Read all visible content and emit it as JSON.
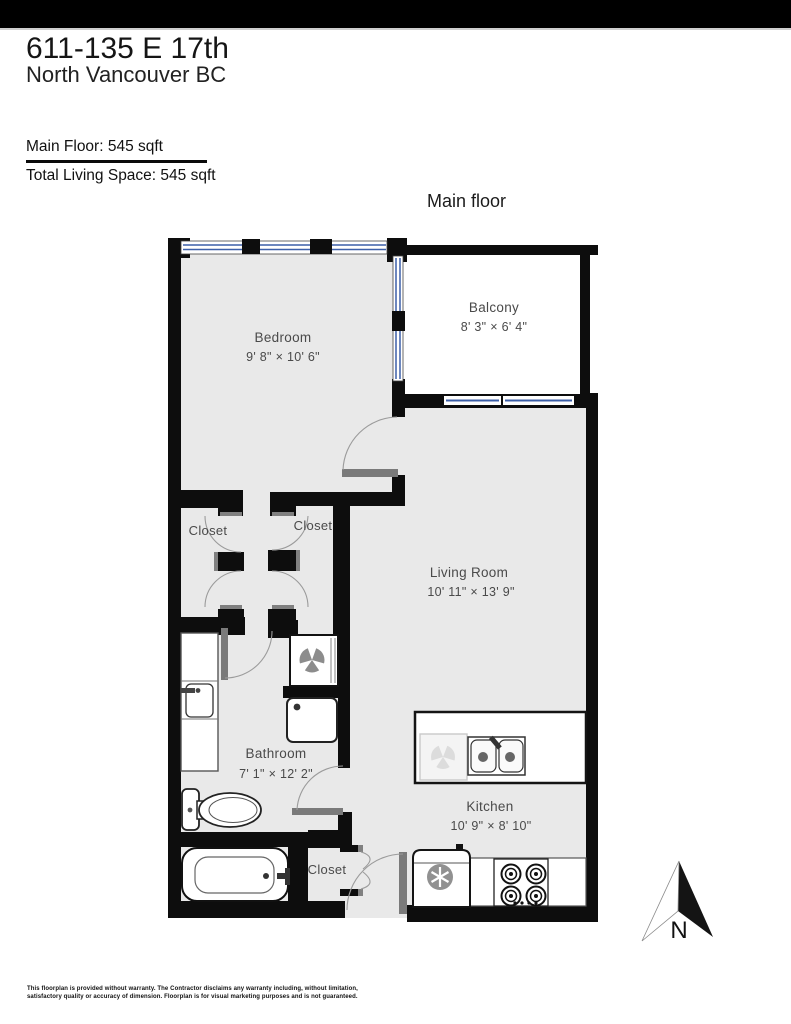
{
  "header": {
    "address_line1": "611-135 E 17th",
    "address_line2": "North Vancouver BC",
    "main_floor_label": "Main Floor: 545 sqft",
    "total_label": "Total Living Space: 545 sqft"
  },
  "plan": {
    "title": "Main floor",
    "compass": "N",
    "rooms": {
      "bedroom": {
        "name": "Bedroom",
        "dims": "9' 8\" × 10' 6\""
      },
      "balcony": {
        "name": "Balcony",
        "dims": "8' 3\" × 6' 4\""
      },
      "living_room": {
        "name": "Living Room",
        "dims": "10' 11\" × 13' 9\""
      },
      "closet_left": {
        "name": "Closet"
      },
      "closet_right": {
        "name": "Closet"
      },
      "bathroom": {
        "name": "Bathroom",
        "dims": "7' 1\" × 12' 2\""
      },
      "kitchen": {
        "name": "Kitchen",
        "dims": "10' 9\" × 8' 10\""
      },
      "closet_entry": {
        "name": "Closet"
      }
    }
  },
  "footer": {
    "disclaimer_line1": "This floorplan is provided without warranty. The Contractor disclaims any warranty including, without limitation,",
    "disclaimer_line2": "satisfactory quality or accuracy of dimension. Floorplan is for visual marketing purposes and is not guaranteed."
  },
  "colors": {
    "wall": "#0d0d0d",
    "floor": "#e9e9e9",
    "window_blue": "#3c5fa8",
    "door_gray": "#7a7a7a"
  }
}
